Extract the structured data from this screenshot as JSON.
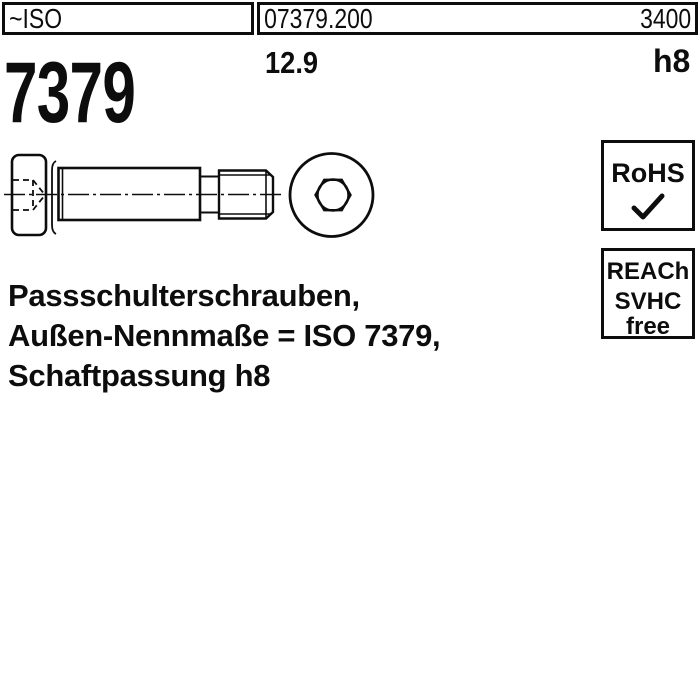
{
  "header": {
    "iso_label": "~ISO",
    "article_number": "07379.200",
    "catalog_code": "3400",
    "standard_number": "7379",
    "strength_class": "12.9",
    "shaft_tolerance": "h8"
  },
  "description": {
    "line1": "Passschulterschrauben,",
    "line2": "Außen-Nennmaße = ISO 7379,",
    "line3": "Schaftpassung h8"
  },
  "badges": {
    "rohs": {
      "label": "RoHS",
      "icon": "checkmark"
    },
    "reach": {
      "line1": "REACh",
      "line2": "SVHC",
      "line3": "free"
    }
  },
  "drawing": {
    "subject": "shoulder-screw",
    "views": [
      "side-view",
      "front-view-hex-socket"
    ]
  },
  "colors": {
    "ink": "#0d0d0d",
    "background": "#ffffff"
  }
}
